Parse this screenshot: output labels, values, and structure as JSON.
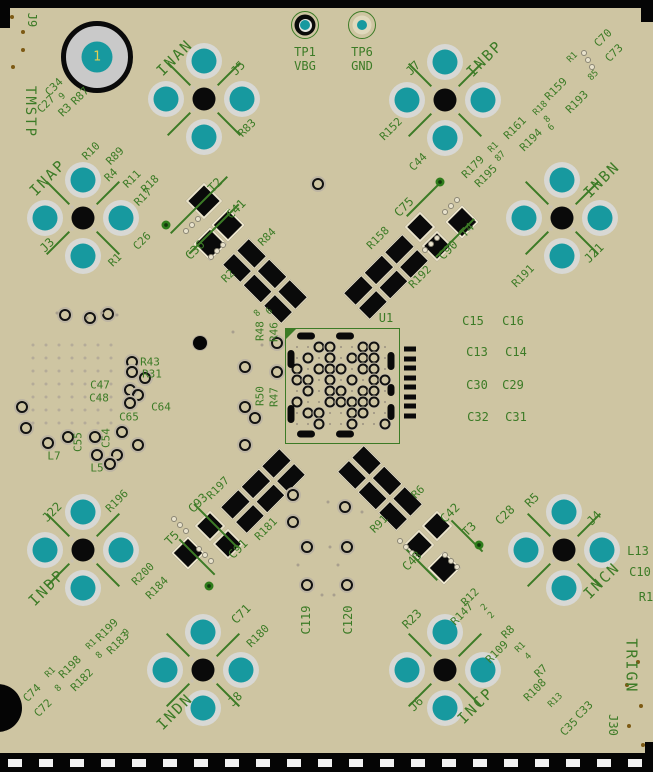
{
  "view": {
    "kind": "pcb-layout-screenshot"
  },
  "colors": {
    "board": "#cec5a2",
    "silk": "#3c7b26",
    "pad_teal": "#17999f",
    "pad_ring": "#d8d8d4",
    "component_black": "#0a0a0a",
    "pad_cream": "#ece5cc",
    "hole_gray": "#c9c9c9",
    "pin1_yellow": "#e3cf52",
    "fiducial_brown": "#7d5a14",
    "edge_black": "#050505"
  },
  "hole_marker": {
    "label": "1",
    "x": 97,
    "y": 57
  },
  "test_points": [
    {
      "id": "tp1",
      "ring": "black",
      "x": 305,
      "y": 25
    },
    {
      "id": "tp6",
      "ring": "green",
      "x": 362,
      "y": 25
    }
  ],
  "ic": {
    "x": 285,
    "y": 328,
    "w": 113,
    "h": 114
  },
  "connectors": [
    {
      "id": "j5-inan",
      "x": 204,
      "y": 99
    },
    {
      "id": "j7-inbp",
      "x": 445,
      "y": 100
    },
    {
      "id": "j3-inap",
      "x": 83,
      "y": 218
    },
    {
      "id": "j21-inbn",
      "x": 562,
      "y": 218
    },
    {
      "id": "j22-indp",
      "x": 83,
      "y": 550
    },
    {
      "id": "j4-incn",
      "x": 564,
      "y": 550
    },
    {
      "id": "j8-indn",
      "x": 203,
      "y": 670
    },
    {
      "id": "j6-incp",
      "x": 445,
      "y": 670
    }
  ],
  "silkscreen": [
    {
      "t": "J9",
      "x": 32,
      "y": 20,
      "r": 90,
      "s": 12
    },
    {
      "t": "TMSTP",
      "x": 30,
      "y": 112,
      "r": 90,
      "s": 14
    },
    {
      "t": "INAN",
      "x": 175,
      "y": 58,
      "r": -45,
      "s": 15
    },
    {
      "t": "J5",
      "x": 238,
      "y": 68,
      "r": -45,
      "s": 12
    },
    {
      "t": "R83",
      "x": 247,
      "y": 128,
      "r": -45,
      "s": 11
    },
    {
      "t": "TP1",
      "x": 305,
      "y": 52,
      "r": 0,
      "s": 12
    },
    {
      "t": "VBG",
      "x": 305,
      "y": 66,
      "r": 0,
      "s": 12
    },
    {
      "t": "TP6",
      "x": 362,
      "y": 52,
      "r": 0,
      "s": 12
    },
    {
      "t": "GND",
      "x": 362,
      "y": 66,
      "r": 0,
      "s": 12
    },
    {
      "t": "J7",
      "x": 413,
      "y": 68,
      "r": -45,
      "s": 12
    },
    {
      "t": "INBP",
      "x": 485,
      "y": 59,
      "r": -45,
      "s": 15
    },
    {
      "t": "R152",
      "x": 391,
      "y": 129,
      "r": -45,
      "s": 11
    },
    {
      "t": "C44",
      "x": 418,
      "y": 162,
      "r": -45,
      "s": 11
    },
    {
      "t": "R179",
      "x": 473,
      "y": 167,
      "r": -45,
      "s": 11
    },
    {
      "t": "R195",
      "x": 486,
      "y": 176,
      "r": -45,
      "s": 11
    },
    {
      "t": "R1",
      "x": 494,
      "y": 148,
      "r": -45,
      "s": 9
    },
    {
      "t": "87",
      "x": 501,
      "y": 157,
      "r": -45,
      "s": 9
    },
    {
      "t": "R161",
      "x": 515,
      "y": 128,
      "r": -45,
      "s": 11
    },
    {
      "t": "R194",
      "x": 531,
      "y": 140,
      "r": -45,
      "s": 11
    },
    {
      "t": "R18",
      "x": 541,
      "y": 109,
      "r": -45,
      "s": 9
    },
    {
      "t": "8",
      "x": 548,
      "y": 120,
      "r": -45,
      "s": 9
    },
    {
      "t": "6",
      "x": 552,
      "y": 128,
      "r": -45,
      "s": 9
    },
    {
      "t": "R159",
      "x": 556,
      "y": 89,
      "r": -45,
      "s": 11
    },
    {
      "t": "R193",
      "x": 577,
      "y": 102,
      "r": -45,
      "s": 11
    },
    {
      "t": "R1",
      "x": 573,
      "y": 58,
      "r": -45,
      "s": 9
    },
    {
      "t": "85",
      "x": 594,
      "y": 76,
      "r": -45,
      "s": 9
    },
    {
      "t": "C70",
      "x": 603,
      "y": 38,
      "r": -45,
      "s": 11
    },
    {
      "t": "C73",
      "x": 614,
      "y": 53,
      "r": -45,
      "s": 11
    },
    {
      "t": "INBN",
      "x": 602,
      "y": 180,
      "r": -45,
      "s": 15
    },
    {
      "t": "J21",
      "x": 594,
      "y": 253,
      "r": -45,
      "s": 12
    },
    {
      "t": "R191",
      "x": 523,
      "y": 276,
      "r": -45,
      "s": 11
    },
    {
      "t": "INAP",
      "x": 48,
      "y": 178,
      "r": -45,
      "s": 15
    },
    {
      "t": "J3",
      "x": 47,
      "y": 245,
      "r": -45,
      "s": 12
    },
    {
      "t": "R1",
      "x": 115,
      "y": 260,
      "r": -45,
      "s": 11
    },
    {
      "t": "C26",
      "x": 142,
      "y": 241,
      "r": -45,
      "s": 11
    },
    {
      "t": "C34",
      "x": 54,
      "y": 87,
      "r": -45,
      "s": 11
    },
    {
      "t": "C27",
      "x": 46,
      "y": 104,
      "r": -45,
      "s": 11
    },
    {
      "t": "9",
      "x": 63,
      "y": 97,
      "r": -45,
      "s": 9
    },
    {
      "t": "R3",
      "x": 65,
      "y": 110,
      "r": -45,
      "s": 11
    },
    {
      "t": "R87",
      "x": 80,
      "y": 96,
      "r": -45,
      "s": 11
    },
    {
      "t": "R10",
      "x": 91,
      "y": 151,
      "r": -45,
      "s": 11
    },
    {
      "t": "R89",
      "x": 115,
      "y": 156,
      "r": -45,
      "s": 11
    },
    {
      "t": "R4",
      "x": 111,
      "y": 175,
      "r": -45,
      "s": 11
    },
    {
      "t": "R11",
      "x": 132,
      "y": 179,
      "r": -45,
      "s": 11
    },
    {
      "t": "R18",
      "x": 150,
      "y": 184,
      "r": -45,
      "s": 11
    },
    {
      "t": "R17",
      "x": 143,
      "y": 197,
      "r": -45,
      "s": 11
    },
    {
      "t": "T2",
      "x": 215,
      "y": 185,
      "r": -45,
      "s": 12
    },
    {
      "t": "C41",
      "x": 236,
      "y": 209,
      "r": -45,
      "s": 12
    },
    {
      "t": "C36",
      "x": 195,
      "y": 250,
      "r": -45,
      "s": 12
    },
    {
      "t": "R84",
      "x": 267,
      "y": 237,
      "r": -45,
      "s": 11
    },
    {
      "t": "R2",
      "x": 228,
      "y": 276,
      "r": -45,
      "s": 11
    },
    {
      "t": "8",
      "x": 258,
      "y": 314,
      "r": -45,
      "s": 9
    },
    {
      "t": "6",
      "x": 270,
      "y": 312,
      "r": -45,
      "s": 9
    },
    {
      "t": "C75",
      "x": 404,
      "y": 207,
      "r": -45,
      "s": 12
    },
    {
      "t": "R158",
      "x": 378,
      "y": 238,
      "r": -45,
      "s": 11
    },
    {
      "t": "R192",
      "x": 420,
      "y": 277,
      "r": -45,
      "s": 11
    },
    {
      "t": "C90",
      "x": 448,
      "y": 250,
      "r": -45,
      "s": 12
    },
    {
      "t": "T4",
      "x": 467,
      "y": 230,
      "r": -45,
      "s": 12
    },
    {
      "t": "U1",
      "x": 386,
      "y": 318,
      "r": 0,
      "s": 12
    },
    {
      "t": "R48",
      "x": 260,
      "y": 331,
      "r": -90,
      "s": 11
    },
    {
      "t": "R46",
      "x": 274,
      "y": 332,
      "r": -90,
      "s": 11
    },
    {
      "t": "R50",
      "x": 260,
      "y": 396,
      "r": -90,
      "s": 11
    },
    {
      "t": "R47",
      "x": 274,
      "y": 397,
      "r": -90,
      "s": 11
    },
    {
      "t": "C15",
      "x": 473,
      "y": 321,
      "r": 0,
      "s": 12
    },
    {
      "t": "C16",
      "x": 513,
      "y": 321,
      "r": 0,
      "s": 12
    },
    {
      "t": "C13",
      "x": 477,
      "y": 352,
      "r": 0,
      "s": 12
    },
    {
      "t": "C14",
      "x": 516,
      "y": 352,
      "r": 0,
      "s": 12
    },
    {
      "t": "C30",
      "x": 477,
      "y": 385,
      "r": 0,
      "s": 12
    },
    {
      "t": "C29",
      "x": 513,
      "y": 385,
      "r": 0,
      "s": 12
    },
    {
      "t": "C32",
      "x": 478,
      "y": 417,
      "r": 0,
      "s": 12
    },
    {
      "t": "C31",
      "x": 516,
      "y": 417,
      "r": 0,
      "s": 12
    },
    {
      "t": "R43",
      "x": 150,
      "y": 362,
      "r": 0,
      "s": 11
    },
    {
      "t": "R31",
      "x": 152,
      "y": 374,
      "r": 0,
      "s": 11
    },
    {
      "t": "C47",
      "x": 100,
      "y": 385,
      "r": 0,
      "s": 11
    },
    {
      "t": "C48",
      "x": 99,
      "y": 398,
      "r": 0,
      "s": 11
    },
    {
      "t": "C64",
      "x": 161,
      "y": 407,
      "r": 0,
      "s": 11
    },
    {
      "t": "C65",
      "x": 129,
      "y": 417,
      "r": 0,
      "s": 11
    },
    {
      "t": "C54",
      "x": 106,
      "y": 438,
      "r": -90,
      "s": 11
    },
    {
      "t": "C55",
      "x": 78,
      "y": 442,
      "r": -90,
      "s": 11
    },
    {
      "t": "L7",
      "x": 54,
      "y": 456,
      "r": 0,
      "s": 11
    },
    {
      "t": "L5",
      "x": 97,
      "y": 468,
      "r": 0,
      "s": 11
    },
    {
      "t": "J22",
      "x": 52,
      "y": 512,
      "r": -45,
      "s": 12
    },
    {
      "t": "R196",
      "x": 117,
      "y": 501,
      "r": -45,
      "s": 11
    },
    {
      "t": "INDP",
      "x": 47,
      "y": 588,
      "r": -45,
      "s": 15
    },
    {
      "t": "T5",
      "x": 172,
      "y": 538,
      "r": -45,
      "s": 12
    },
    {
      "t": "C93",
      "x": 198,
      "y": 503,
      "r": -45,
      "s": 12
    },
    {
      "t": "C91",
      "x": 238,
      "y": 549,
      "r": -45,
      "s": 12
    },
    {
      "t": "R197",
      "x": 218,
      "y": 488,
      "r": -45,
      "s": 11
    },
    {
      "t": "R181",
      "x": 266,
      "y": 529,
      "r": -45,
      "s": 11
    },
    {
      "t": "C74",
      "x": 32,
      "y": 693,
      "r": -45,
      "s": 11
    },
    {
      "t": "C72",
      "x": 43,
      "y": 708,
      "r": -45,
      "s": 11
    },
    {
      "t": "R1",
      "x": 51,
      "y": 673,
      "r": -45,
      "s": 9
    },
    {
      "t": "8",
      "x": 59,
      "y": 689,
      "r": -45,
      "s": 9
    },
    {
      "t": "R198",
      "x": 70,
      "y": 667,
      "r": -45,
      "s": 11
    },
    {
      "t": "R182",
      "x": 82,
      "y": 680,
      "r": -45,
      "s": 11
    },
    {
      "t": "R1",
      "x": 92,
      "y": 645,
      "r": -45,
      "s": 9
    },
    {
      "t": "8",
      "x": 100,
      "y": 656,
      "r": -45,
      "s": 9
    },
    {
      "t": "R199",
      "x": 107,
      "y": 630,
      "r": -45,
      "s": 11
    },
    {
      "t": "R183",
      "x": 118,
      "y": 643,
      "r": -45,
      "s": 11
    },
    {
      "t": "9",
      "x": 127,
      "y": 633,
      "r": -45,
      "s": 9
    },
    {
      "t": "R200",
      "x": 143,
      "y": 574,
      "r": -45,
      "s": 11
    },
    {
      "t": "R184",
      "x": 157,
      "y": 588,
      "r": -45,
      "s": 11
    },
    {
      "t": "INDN",
      "x": 175,
      "y": 712,
      "r": -45,
      "s": 15
    },
    {
      "t": "J8",
      "x": 235,
      "y": 699,
      "r": -45,
      "s": 12
    },
    {
      "t": "C71",
      "x": 241,
      "y": 614,
      "r": -45,
      "s": 12
    },
    {
      "t": "R180",
      "x": 258,
      "y": 636,
      "r": -45,
      "s": 11
    },
    {
      "t": "C119",
      "x": 306,
      "y": 620,
      "r": -90,
      "s": 12
    },
    {
      "t": "C120",
      "x": 348,
      "y": 620,
      "r": -90,
      "s": 12
    },
    {
      "t": "R91",
      "x": 379,
      "y": 524,
      "r": -45,
      "s": 11
    },
    {
      "t": "R6",
      "x": 418,
      "y": 492,
      "r": -45,
      "s": 11
    },
    {
      "t": "C43",
      "x": 412,
      "y": 561,
      "r": -45,
      "s": 12
    },
    {
      "t": "C42",
      "x": 450,
      "y": 513,
      "r": -45,
      "s": 12
    },
    {
      "t": "T3",
      "x": 469,
      "y": 529,
      "r": -45,
      "s": 12
    },
    {
      "t": "C28",
      "x": 505,
      "y": 515,
      "r": -45,
      "s": 12
    },
    {
      "t": "R5",
      "x": 532,
      "y": 500,
      "r": -45,
      "s": 12
    },
    {
      "t": "J4",
      "x": 594,
      "y": 518,
      "r": -45,
      "s": 12
    },
    {
      "t": "INCN",
      "x": 602,
      "y": 581,
      "r": -45,
      "s": 15
    },
    {
      "t": "L13",
      "x": 638,
      "y": 551,
      "r": 0,
      "s": 12
    },
    {
      "t": "C10",
      "x": 640,
      "y": 572,
      "r": 0,
      "s": 12
    },
    {
      "t": "R1",
      "x": 646,
      "y": 597,
      "r": 0,
      "s": 12
    },
    {
      "t": "R23",
      "x": 412,
      "y": 619,
      "r": -45,
      "s": 12
    },
    {
      "t": "J6",
      "x": 416,
      "y": 704,
      "r": -45,
      "s": 12
    },
    {
      "t": "INCP",
      "x": 476,
      "y": 706,
      "r": -45,
      "s": 15
    },
    {
      "t": "R12",
      "x": 470,
      "y": 597,
      "r": -45,
      "s": 11
    },
    {
      "t": "R147",
      "x": 462,
      "y": 614,
      "r": -45,
      "s": 11
    },
    {
      "t": "2",
      "x": 485,
      "y": 608,
      "r": -45,
      "s": 9
    },
    {
      "t": "2",
      "x": 492,
      "y": 616,
      "r": -45,
      "s": 9
    },
    {
      "t": "R8",
      "x": 508,
      "y": 632,
      "r": -45,
      "s": 11
    },
    {
      "t": "R109",
      "x": 497,
      "y": 652,
      "r": -45,
      "s": 11
    },
    {
      "t": "R1",
      "x": 521,
      "y": 648,
      "r": -45,
      "s": 9
    },
    {
      "t": "4",
      "x": 529,
      "y": 657,
      "r": -45,
      "s": 9
    },
    {
      "t": "R7",
      "x": 541,
      "y": 671,
      "r": -45,
      "s": 11
    },
    {
      "t": "R108",
      "x": 535,
      "y": 690,
      "r": -45,
      "s": 11
    },
    {
      "t": "R13",
      "x": 556,
      "y": 701,
      "r": -45,
      "s": 9
    },
    {
      "t": "C33",
      "x": 584,
      "y": 710,
      "r": -45,
      "s": 11
    },
    {
      "t": "C35",
      "x": 569,
      "y": 727,
      "r": -45,
      "s": 11
    },
    {
      "t": "TRIGN",
      "x": 631,
      "y": 666,
      "r": 90,
      "s": 15
    },
    {
      "t": "J30",
      "x": 613,
      "y": 725,
      "r": 90,
      "s": 12
    }
  ],
  "silk_lines": [
    {
      "x": 199,
      "y": 205,
      "len": 80,
      "r": -45
    },
    {
      "x": 214,
      "y": 229,
      "len": 70,
      "r": -45
    },
    {
      "x": 423,
      "y": 200,
      "len": 46,
      "r": -45
    },
    {
      "x": 455,
      "y": 238,
      "len": 54,
      "r": -45
    },
    {
      "x": 197,
      "y": 557,
      "len": 50,
      "r": 45
    },
    {
      "x": 216,
      "y": 526,
      "len": 62,
      "r": 45
    },
    {
      "x": 467,
      "y": 536,
      "len": 44,
      "r": 45
    },
    {
      "x": 421,
      "y": 564,
      "len": 46,
      "r": 45
    }
  ],
  "chips": [
    {
      "x": 204,
      "y": 201,
      "s": 22
    },
    {
      "x": 228,
      "y": 225,
      "s": 20
    },
    {
      "x": 210,
      "y": 244,
      "s": 20
    },
    {
      "x": 420,
      "y": 227,
      "s": 18
    },
    {
      "x": 437,
      "y": 246,
      "s": 18
    },
    {
      "x": 462,
      "y": 222,
      "s": 20
    },
    {
      "x": 188,
      "y": 553,
      "s": 20
    },
    {
      "x": 210,
      "y": 526,
      "s": 18
    },
    {
      "x": 228,
      "y": 544,
      "s": 18
    },
    {
      "x": 437,
      "y": 526,
      "s": 18
    },
    {
      "x": 419,
      "y": 545,
      "s": 18
    },
    {
      "x": 444,
      "y": 568,
      "s": 20
    }
  ],
  "bands": [
    {
      "x": 265,
      "y": 281,
      "r": 45
    },
    {
      "x": 386,
      "y": 277,
      "r": -45
    },
    {
      "x": 263,
      "y": 491,
      "r": -45
    },
    {
      "x": 380,
      "y": 488,
      "r": 45
    }
  ],
  "vias_green": [
    [
      166,
      225
    ],
    [
      440,
      182
    ],
    [
      209,
      586
    ],
    [
      479,
      545
    ]
  ],
  "vias": [
    [
      65,
      315
    ],
    [
      90,
      318
    ],
    [
      108,
      314
    ],
    [
      132,
      362
    ],
    [
      132,
      372
    ],
    [
      145,
      378
    ],
    [
      130,
      390
    ],
    [
      138,
      395
    ],
    [
      130,
      403
    ],
    [
      122,
      432
    ],
    [
      48,
      443
    ],
    [
      68,
      437
    ],
    [
      95,
      437
    ],
    [
      138,
      445
    ],
    [
      97,
      455
    ],
    [
      117,
      455
    ],
    [
      110,
      464
    ],
    [
      22,
      407
    ],
    [
      26,
      428
    ],
    [
      245,
      367
    ],
    [
      277,
      343
    ],
    [
      277,
      372
    ],
    [
      245,
      407
    ],
    [
      255,
      418
    ],
    [
      245,
      445
    ],
    [
      318,
      184
    ],
    [
      293,
      495
    ],
    [
      293,
      522
    ],
    [
      307,
      547
    ],
    [
      307,
      585
    ],
    [
      345,
      507
    ],
    [
      347,
      547
    ],
    [
      347,
      585
    ]
  ],
  "via_cross": [
    200,
    343
  ],
  "tiny_dots": [
    [
      57,
      313
    ],
    [
      87,
      318
    ],
    [
      102,
      313
    ],
    [
      117,
      315
    ],
    [
      328,
      502
    ],
    [
      330,
      547
    ],
    [
      338,
      565
    ],
    [
      298,
      565
    ],
    [
      233,
      332
    ],
    [
      262,
      345
    ],
    [
      362,
      512
    ],
    [
      322,
      595
    ],
    [
      334,
      595
    ]
  ],
  "brown_dots": [
    [
      12,
      17
    ],
    [
      23,
      32
    ],
    [
      23,
      50
    ],
    [
      13,
      67
    ],
    [
      638,
      662
    ],
    [
      627,
      685
    ],
    [
      641,
      706
    ],
    [
      629,
      726
    ],
    [
      643,
      745
    ]
  ],
  "cream_dots": [
    [
      186,
      231
    ],
    [
      192,
      225
    ],
    [
      198,
      219
    ],
    [
      211,
      257
    ],
    [
      217,
      251
    ],
    [
      223,
      245
    ],
    [
      445,
      212
    ],
    [
      451,
      206
    ],
    [
      457,
      200
    ],
    [
      425,
      250
    ],
    [
      431,
      244
    ],
    [
      437,
      238
    ],
    [
      174,
      519
    ],
    [
      180,
      525
    ],
    [
      186,
      531
    ],
    [
      199,
      549
    ],
    [
      205,
      555
    ],
    [
      211,
      561
    ],
    [
      400,
      541
    ],
    [
      406,
      547
    ],
    [
      412,
      553
    ],
    [
      445,
      555
    ],
    [
      451,
      561
    ],
    [
      457,
      567
    ],
    [
      584,
      53
    ],
    [
      588,
      60
    ],
    [
      592,
      67
    ]
  ],
  "dot_field": {
    "x": 33,
    "y": 345,
    "cols": 7,
    "rows": 7,
    "step": 13
  },
  "u1_grid": {
    "x": 297,
    "y": 347,
    "step": 11,
    "rows": [
      "..oo..oo.",
      ".o.o.ooo.",
      "o.ooo.oo.",
      "oo.o.o.oo",
      ".o.oo.oo.",
      "o..ooooo.",
      ".oo..oo..",
      "..o..o..o"
    ]
  },
  "u1_ovals": [
    [
      306,
      336,
      18,
      7
    ],
    [
      345,
      336,
      18,
      7
    ],
    [
      306,
      434,
      18,
      7
    ],
    [
      345,
      434,
      18,
      7
    ],
    [
      291,
      359,
      7,
      18
    ],
    [
      291,
      414,
      7,
      18
    ],
    [
      391,
      361,
      7,
      18
    ],
    [
      391,
      390,
      7,
      12
    ],
    [
      391,
      412,
      7,
      16
    ]
  ],
  "u1_pins": {
    "x": 404,
    "y0": 349,
    "step": 9.5,
    "count": 8,
    "w": 12,
    "h": 5
  },
  "edge_dashes": {
    "count": 21,
    "x0": 8,
    "step": 31,
    "y": 759,
    "w": 14,
    "h": 8
  }
}
